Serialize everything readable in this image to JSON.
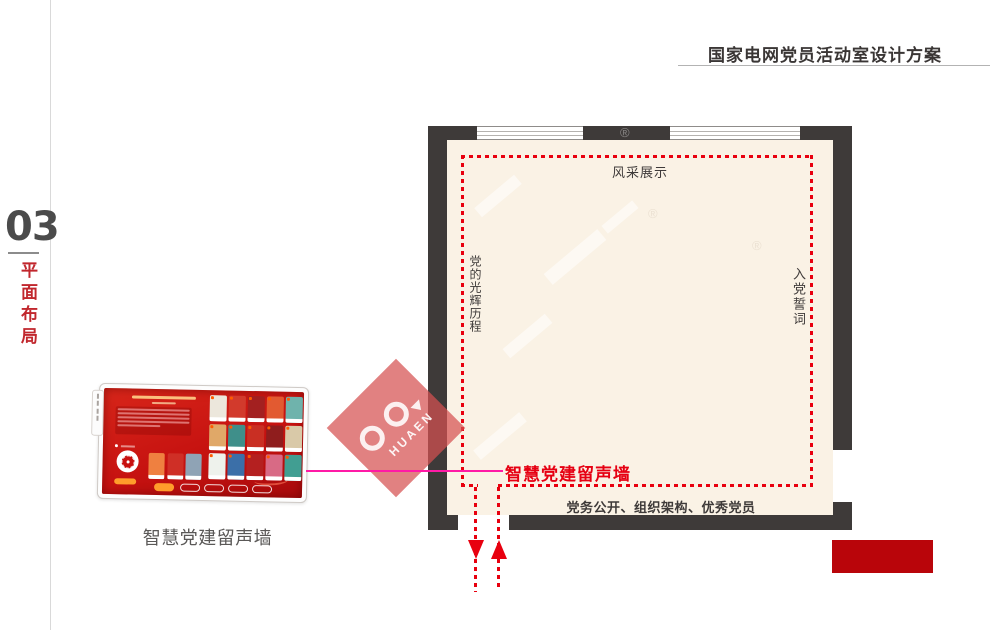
{
  "header": {
    "title": "国家电网党员活动室设计方案"
  },
  "section_tab": {
    "number": "03",
    "label": "平面布局"
  },
  "floor_plan": {
    "wall_labels": {
      "top": "风采展示",
      "left_vertical": "党的光辉历程",
      "right_vertical": "入党誓词",
      "bottom": "党务公开、组织架构、优秀党员",
      "smart_wall": "智慧党建留声墙"
    },
    "colors": {
      "wall": "#3e3a39",
      "floor": "#faf2e5",
      "boundary_dashed": "#e8000f",
      "route_arrow": "#e8000f"
    }
  },
  "device_panel": {
    "caption": "智慧党建留声墙",
    "screen": {
      "base_color": "#c61210",
      "accent_pill_color": "#ff9d2b",
      "left_card_colors": [
        "#ef8040",
        "#cf2f26",
        "#8fa3b5"
      ],
      "grid_colors": [
        "#ece7dc",
        "#d23a2c",
        "#a32020",
        "#e25a31",
        "#6fb3ac",
        "#e0a868",
        "#3f8f8a",
        "#c92f23",
        "#8f1d1d",
        "#d9c9a8",
        "#eef2ec",
        "#3b6fa8",
        "#b42020",
        "#d86a85",
        "#419e92"
      ],
      "outline_pill_count": 4
    }
  },
  "connector": {
    "color": "#ff1aa6"
  },
  "watermark": {
    "brand_text": "HUAEN",
    "registered_mark": "®",
    "diamond_color": "rgba(214,80,80,0.72)"
  },
  "footer": {
    "red_block_color": "#b9050a"
  }
}
